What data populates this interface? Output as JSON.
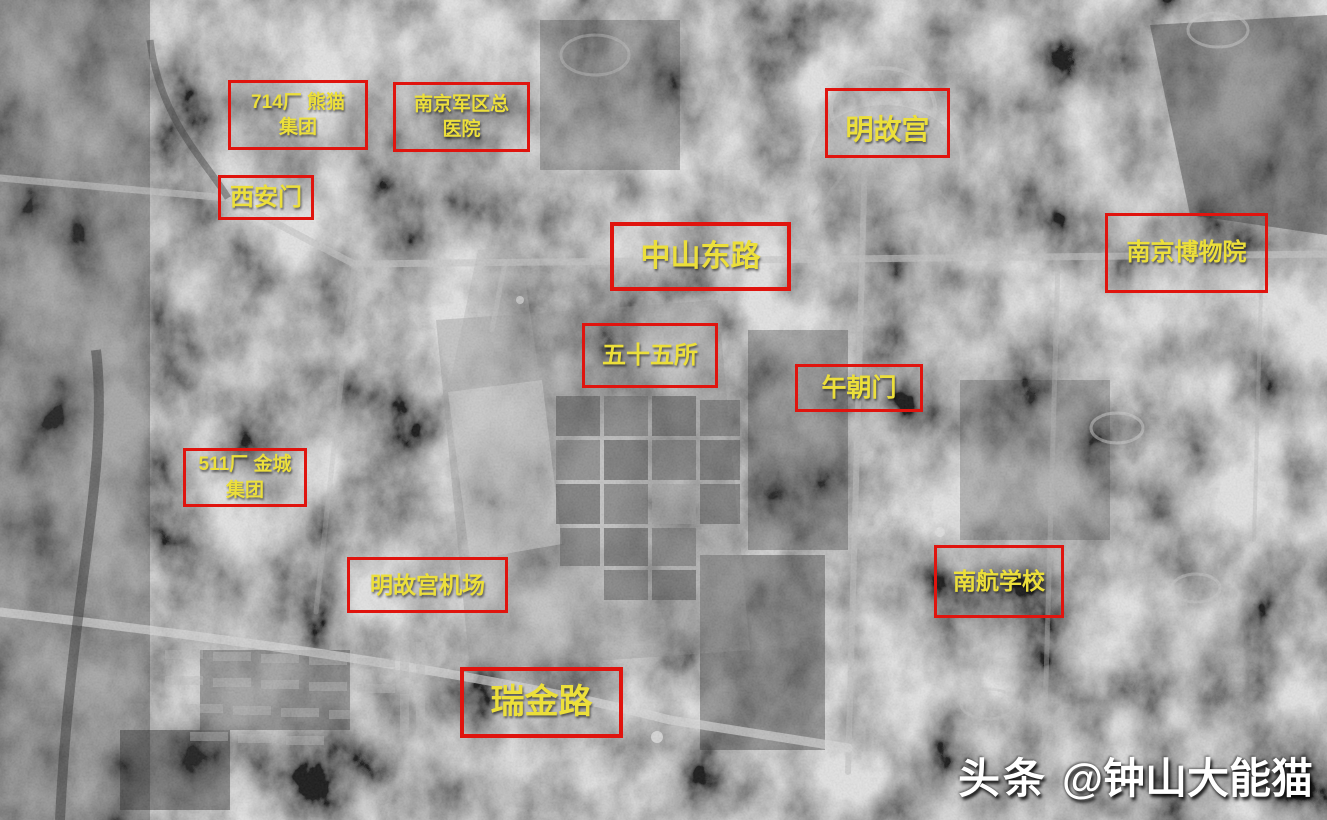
{
  "annotations": [
    {
      "name": "factory-714-panda-group",
      "text": "714厂 熊猫\n集团"
    },
    {
      "name": "nanjing-military-region-general-hospital",
      "text": "南京军区总\n医院"
    },
    {
      "name": "xian-gate",
      "text": "西安门"
    },
    {
      "name": "ming-palace",
      "text": "明故宫"
    },
    {
      "name": "zhongshan-east-road",
      "text": "中山东路"
    },
    {
      "name": "nanjing-museum",
      "text": "南京博物院"
    },
    {
      "name": "institute-55",
      "text": "五十五所"
    },
    {
      "name": "wuchao-gate",
      "text": "午朝门"
    },
    {
      "name": "factory-511-jincheng-group",
      "text": "511厂 金城\n集团"
    },
    {
      "name": "ming-palace-airport",
      "text": "明故宫机场"
    },
    {
      "name": "nuaa-school",
      "text": "南航学校"
    },
    {
      "name": "ruijin-road",
      "text": "瑞金路"
    }
  ],
  "watermark": {
    "brand": "头条",
    "handle": "@钟山大能猫"
  },
  "colors": {
    "box_red": "#e0140e",
    "label_yellow": "#ecdf3a",
    "watermark_white": "#ffffff"
  }
}
